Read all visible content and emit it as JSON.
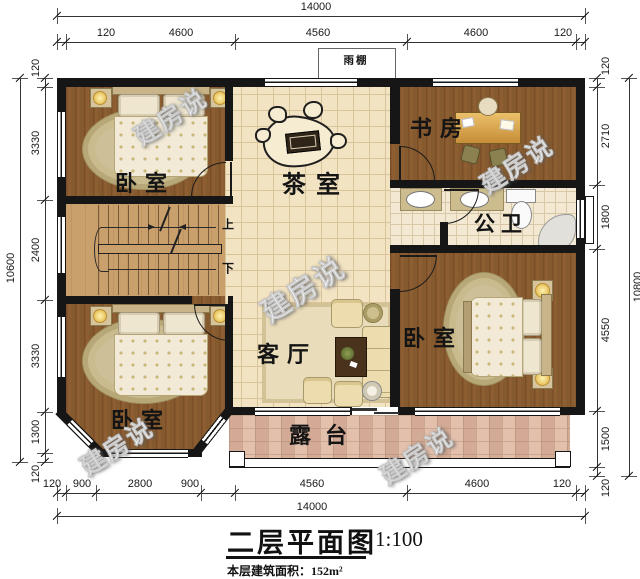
{
  "title": {
    "text": "二层平面图",
    "scale": "1:100",
    "area_note": "本层建筑面积：152m²"
  },
  "rooms": {
    "bedroom_top_left": "卧室",
    "tea_room": "茶室",
    "study": "书房",
    "bathroom": "公卫",
    "living_room": "客厅",
    "bedroom_right": "卧室",
    "bedroom_bottom_left": "卧室",
    "terrace": "露台",
    "rain_canopy": "雨棚"
  },
  "stairs": {
    "up": "上",
    "down": "下"
  },
  "watermark": {
    "text": "建房说"
  },
  "dimensions": {
    "top": {
      "overall": "14000",
      "segments": [
        "120",
        "4600",
        "4560",
        "4600",
        "120"
      ]
    },
    "bottom": {
      "overall": "14000",
      "segments": [
        "120",
        "900",
        "2800",
        "900",
        "4560",
        "4600",
        "120"
      ]
    },
    "left": {
      "overall": "10600",
      "segments": [
        "120",
        "3330",
        "2400",
        "3330",
        "1300",
        "120"
      ]
    },
    "right": {
      "overall": "10800",
      "segments": [
        "120",
        "2710",
        "1800",
        "4550",
        "1500",
        "120"
      ]
    }
  },
  "colors": {
    "wall": "#161616",
    "wood_floor": "#8a5a31",
    "hall_tile": "#f2e3c2",
    "terrace_tile": "#e3c0ac",
    "stair_wood": "#c9a06b"
  }
}
